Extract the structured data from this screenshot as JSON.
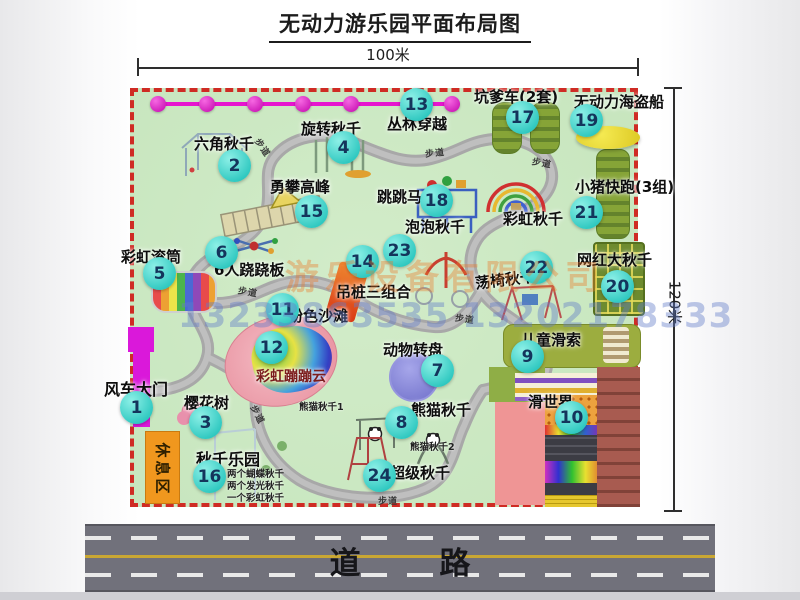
{
  "title": "无动力游乐园平面布局图",
  "dimensions": {
    "width": "100米",
    "height": "120米"
  },
  "road": {
    "label": "道 路"
  },
  "watermark": {
    "company": "游乐设备有限公司",
    "phone": "13233863535 13202178333"
  },
  "map": {
    "path_label": "步道",
    "rest_area": "休息区",
    "rainbow_swing_label": "彩虹秋千",
    "panda_swing_1": "熊猫秋千1",
    "panda_swing_2": "熊猫秋千2",
    "swing_park_notes": [
      "两个蝴蝶秋千",
      "两个发光秋千",
      "一个彩虹秋千"
    ]
  },
  "locations": [
    {
      "num": "1",
      "label": "风车大门"
    },
    {
      "num": "2",
      "label": "六角秋千"
    },
    {
      "num": "3",
      "label": "樱花树"
    },
    {
      "num": "4",
      "label": "旋转秋千"
    },
    {
      "num": "5",
      "label": "彩虹滚筒"
    },
    {
      "num": "6",
      "label": "6人跷跷板"
    },
    {
      "num": "7",
      "label": "动物转盘"
    },
    {
      "num": "8",
      "label": "熊猫秋千"
    },
    {
      "num": "9",
      "label": "儿童滑索"
    },
    {
      "num": "10",
      "label": "滑世界"
    },
    {
      "num": "11",
      "label": "粉色沙滩"
    },
    {
      "num": "12",
      "label": "彩虹蹦蹦云"
    },
    {
      "num": "13",
      "label": "丛林穿越"
    },
    {
      "num": "14",
      "label": "吊桩三组合"
    },
    {
      "num": "15",
      "label": "勇攀高峰"
    },
    {
      "num": "16",
      "label": "秋千乐园"
    },
    {
      "num": "17",
      "label": "坑爹车(2套)"
    },
    {
      "num": "18",
      "label": "跳跳马"
    },
    {
      "num": "19",
      "label": "无动力海盗船"
    },
    {
      "num": "20",
      "label": "网红大秋千"
    },
    {
      "num": "21",
      "label": "小猪快跑(3组)"
    },
    {
      "num": "22",
      "label": "荡椅秋千"
    },
    {
      "num": "23",
      "label": "泡泡秋千"
    },
    {
      "num": "24",
      "label": "超级秋千"
    }
  ],
  "colors": {
    "map_green": "#c9e7c1",
    "border_red": "#cf2b24",
    "badge_teal": "#2fc8c0",
    "gate_magenta": "#da18da",
    "zipline_magenta": "#e615cf",
    "rest_area_orange": "#f0971e",
    "road_gray": "#71717b",
    "road_yellow": "#c9a733"
  }
}
